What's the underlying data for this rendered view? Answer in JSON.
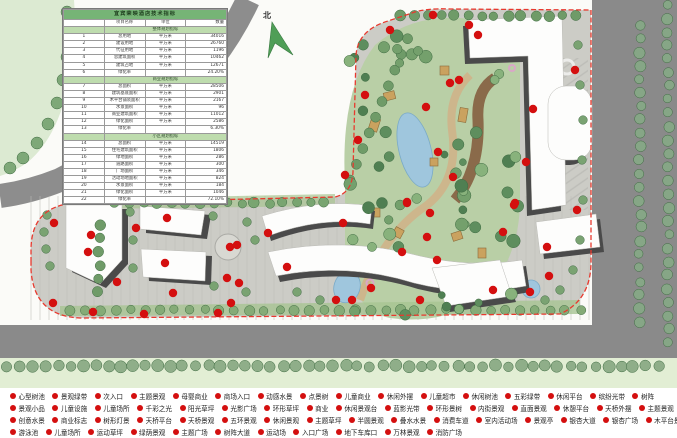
{
  "map": {
    "north_label": "北"
  },
  "table": {
    "title": "宜宾荣映酒店技术指标",
    "columns": [
      "",
      "项目名称",
      "单位",
      "数量"
    ],
    "sections": [
      {
        "label": "整体规划指标",
        "rows": [
          [
            "1",
            "总用地",
            "平方米",
            "34016"
          ],
          [
            "2",
            "建设用地",
            "平方米",
            "26760"
          ],
          [
            "3",
            "代征用地",
            "平方米",
            "1196"
          ],
          [
            "4",
            "总建筑面积",
            "平方米",
            "10462"
          ],
          [
            "5",
            "建筑占地",
            "平方米",
            "12671"
          ],
          [
            "6",
            "绿化率",
            "",
            "24.20%"
          ]
        ]
      },
      {
        "label": "商业规划指标",
        "rows": [
          [
            "7",
            "总面积",
            "平方米",
            "28506"
          ],
          [
            "8",
            "建筑基底面积",
            "平方米",
            "2901"
          ],
          [
            "9",
            "木平台铺装面积",
            "平方米",
            "2167"
          ],
          [
            "10",
            "水景面积",
            "平方米",
            "96"
          ],
          [
            "11",
            "商业建筑面积",
            "平方米",
            "11012"
          ],
          [
            "12",
            "绿化面积",
            "平方米",
            "2586"
          ],
          [
            "13",
            "绿化率",
            "",
            "6.30%"
          ]
        ]
      },
      {
        "label": "小区规划指标",
        "rows": [
          [
            "14",
            "总面积",
            "平方米",
            "14519"
          ],
          [
            "15",
            "住宅建筑面积",
            "平方米",
            "1806"
          ],
          [
            "16",
            "绿地面积",
            "平方米",
            "286"
          ],
          [
            "17",
            "道路面积",
            "平方米",
            "300"
          ],
          [
            "18",
            "广场面积",
            "平方米",
            "346"
          ],
          [
            "19",
            "活动场地面积",
            "平方米",
            "824"
          ],
          [
            "20",
            "水景面积",
            "平方米",
            "184"
          ],
          [
            "21",
            "绿化面积",
            "平方米",
            "1046"
          ],
          [
            "22",
            "绿化率",
            "",
            "72.10%"
          ]
        ]
      }
    ]
  },
  "legend": {
    "rows": [
      [
        "心型树池",
        "景观绿带",
        "次入口",
        "主题景观",
        "母婴商业",
        "商场入口",
        "动感水景",
        "点景树",
        "儿童商业",
        "休闲外摆",
        "儿童超市",
        "休闲树池",
        "五彩绿带",
        "休闲平台",
        "缤纷光带",
        "树阵"
      ],
      [
        "景观小品",
        "儿童设施",
        "儿童场所",
        "千彩之光",
        "阳光草坪",
        "光影广场",
        "环形草坪",
        "商业",
        "休闲景观台",
        "蓝影光带",
        "环形景树",
        "内街景观",
        "直面景观",
        "休憩平台",
        "天桥外摆",
        "主题景观"
      ],
      [
        "创意水景",
        "商业标志",
        "树形灯景",
        "天桥平台",
        "天桥景观",
        "五环景观",
        "休闲景观",
        "主题草坪",
        "半圆景观",
        "叠水水景",
        "消费车道",
        "室内活动场",
        "景观亭",
        "银杏大道",
        "银杏广场",
        "木平台景观"
      ],
      [
        "游泳池",
        "儿童场所",
        "运动草坪",
        "绿荫景观",
        "主题广场",
        "树阵大道",
        "运动场",
        "入口广场",
        "地下车库口",
        "万林景观",
        "消防广场"
      ]
    ]
  },
  "colors": {
    "marker": "#d40f0f",
    "boundary": "#e8392e",
    "road": "#8d8d8d",
    "site_paving": "#ccccc6",
    "lobe_green": "#b9cfa6",
    "water": "#9fc6dd",
    "table_title_green": "#76b476",
    "table_section_green": "#bedcae"
  }
}
